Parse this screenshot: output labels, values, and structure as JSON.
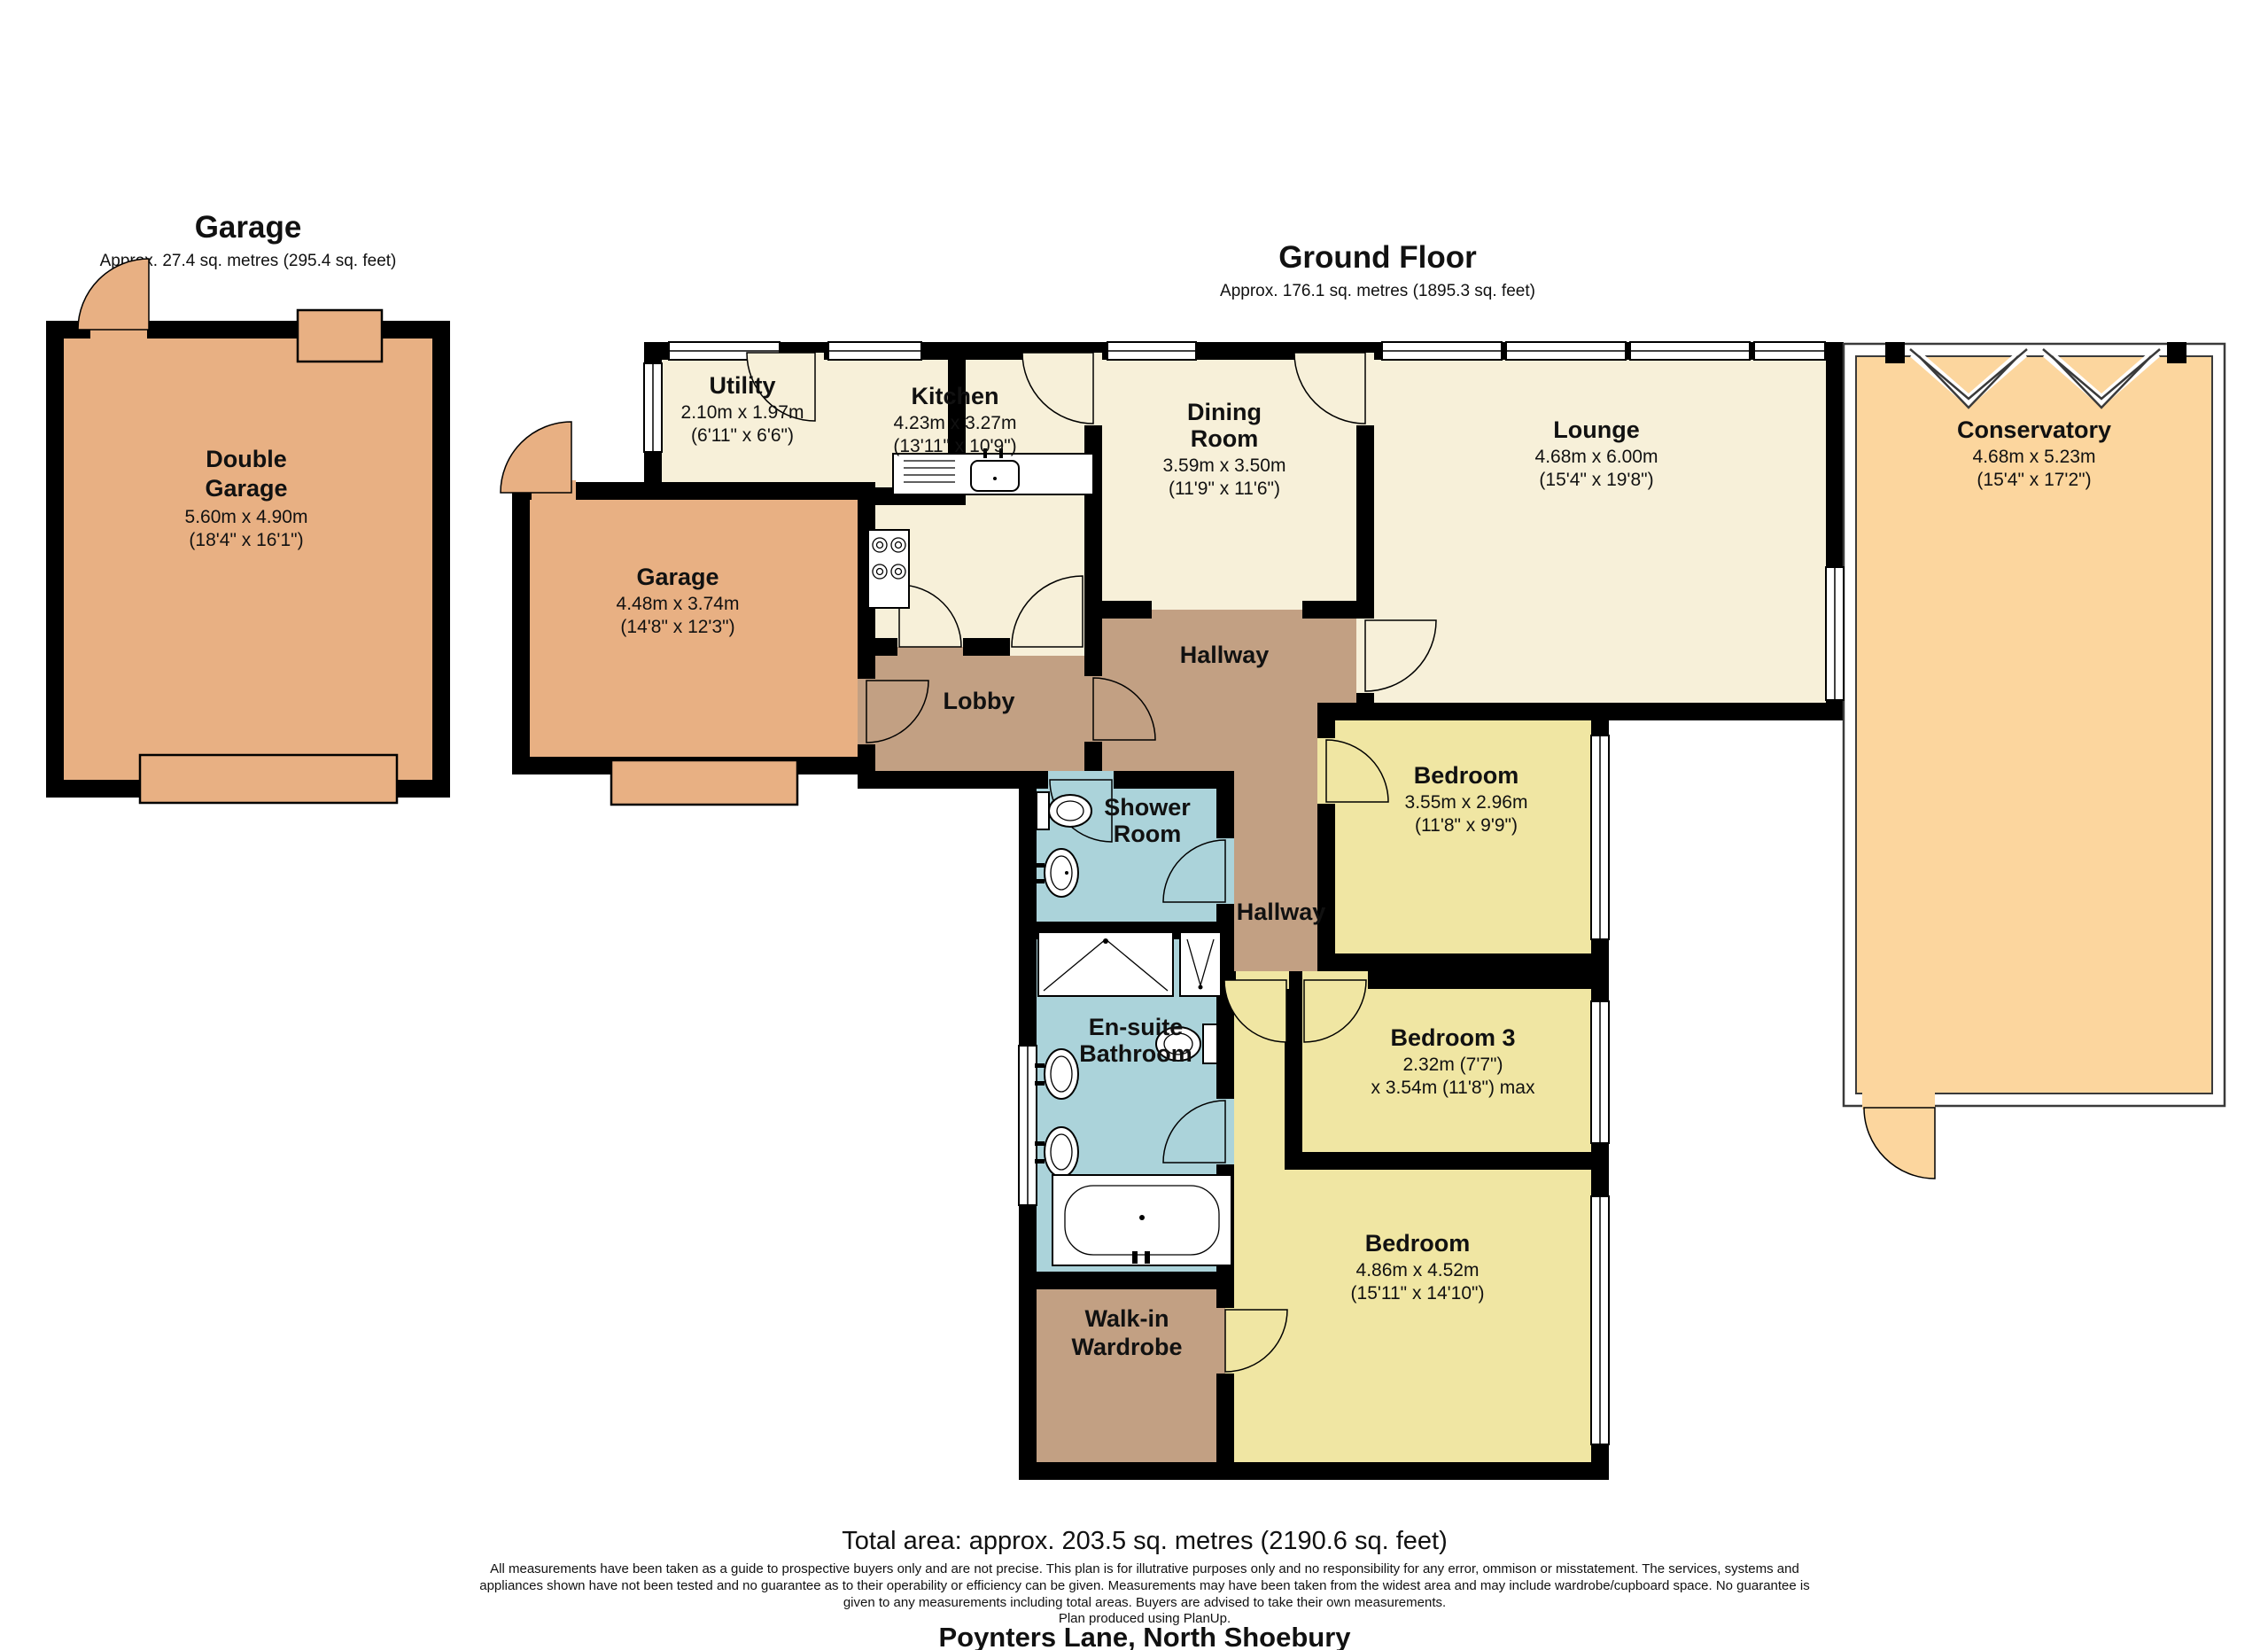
{
  "colors": {
    "cream": "#f7f0d9",
    "tan": "#e8b083",
    "orange": "#fcd69e",
    "brown": "#c2a083",
    "yellow": "#f0e6a3",
    "blue": "#abd3da",
    "white": "#ffffff"
  },
  "garage_block": {
    "title": "Garage",
    "area_label": "Approx. 27.4 sq. metres (295.4 sq. feet)"
  },
  "ground_floor": {
    "title": "Ground Floor",
    "area_label": "Approx. 176.1 sq. metres (1895.3 sq. feet)"
  },
  "rooms": {
    "double_garage": {
      "name_line1": "Double",
      "name_line2": "Garage",
      "dims_m": "5.60m x 4.90m",
      "dims_ft": "(18'4\" x 16'1\")"
    },
    "utility": {
      "name": "Utility",
      "dims_m": "2.10m x 1.97m",
      "dims_ft": "(6'11\" x 6'6\")"
    },
    "kitchen": {
      "name": "Kitchen",
      "dims_m": "4.23m x 3.27m",
      "dims_ft": "(13'11\" x 10'9\")"
    },
    "dining_room": {
      "name_line1": "Dining",
      "name_line2": "Room",
      "dims_m": "3.59m x 3.50m",
      "dims_ft": "(11'9\" x 11'6\")"
    },
    "lounge": {
      "name": "Lounge",
      "dims_m": "4.68m x 6.00m",
      "dims_ft": "(15'4\" x 19'8\")"
    },
    "conservatory": {
      "name": "Conservatory",
      "dims_m": "4.68m x 5.23m",
      "dims_ft": "(15'4\" x 17'2\")"
    },
    "garage": {
      "name": "Garage",
      "dims_m": "4.48m x 3.74m",
      "dims_ft": "(14'8\" x 12'3\")"
    },
    "lobby": {
      "name": "Lobby"
    },
    "hallway": {
      "name": "Hallway"
    },
    "hallway_lower": {
      "name": "Hallway"
    },
    "shower_room": {
      "name_line1": "Shower",
      "name_line2": "Room"
    },
    "ensuite": {
      "name_line1": "En-suite",
      "name_line2": "Bathroom"
    },
    "walk_in_wardrobe": {
      "name_line1": "Walk-in",
      "name_line2": "Wardrobe"
    },
    "bedroom_1": {
      "name": "Bedroom",
      "dims_m": "3.55m x 2.96m",
      "dims_ft": "(11'8\" x 9'9\")"
    },
    "bedroom_3": {
      "name": "Bedroom 3",
      "dims_m": "2.32m (7'7\")",
      "dims_ft": "x 3.54m (11'8\") max"
    },
    "bedroom_2": {
      "name": "Bedroom",
      "dims_m": "4.86m x 4.52m",
      "dims_ft": "(15'11\" x 14'10\")"
    }
  },
  "footer": {
    "total_area": "Total area: approx. 203.5 sq. metres (2190.6 sq. feet)",
    "disclaimer_line1": "All measurements have been taken as a guide to prospective buyers only and are not precise. This plan is for illutrative purposes only and no responsibility for any error, ommison or misstatement. The services, systems and",
    "disclaimer_line2": "appliances shown have not been tested and no guarantee as to their operability or efficiency can be given. Measurements may have been taken from the widest area and may include wardrobe/cupboard space. No guarantee is",
    "disclaimer_line3": "given to any measurements including total areas. Buyers are advised to take their own measurements.",
    "produced": "Plan produced using PlanUp.",
    "address": "Poynters Lane, North Shoebury"
  }
}
